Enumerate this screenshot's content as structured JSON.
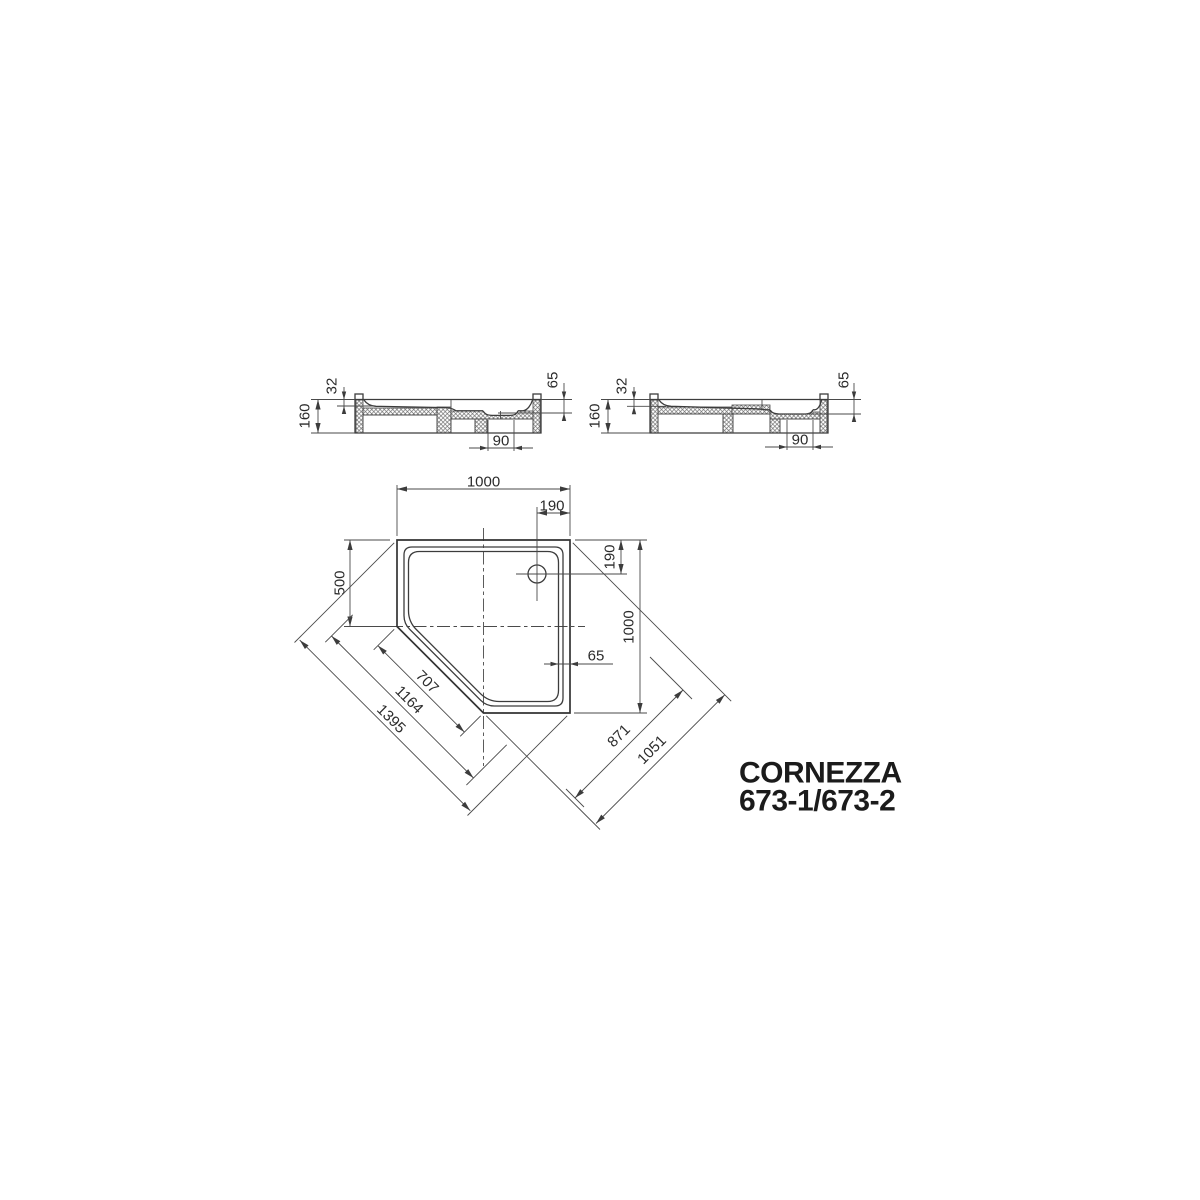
{
  "title": {
    "product_name": "CORNEZZA",
    "model_numbers": "673-1/673-2"
  },
  "section_left": {
    "total_height": "160",
    "rim_depth": "32",
    "drain_depth": "65",
    "drain_width": "90"
  },
  "section_right": {
    "total_height": "160",
    "rim_depth": "32",
    "drain_depth": "65",
    "drain_width": "90"
  },
  "plan": {
    "top_width": "1000",
    "drain_offset_top": "190",
    "left_side": "500",
    "drain_offset_right": "190",
    "right_side": "1000",
    "rim_width": "65",
    "cut_edge": "707",
    "diag_mid": "1164",
    "diag_outer": "1395",
    "cut_to_drain": "871",
    "cut_to_corner": "1051"
  }
}
